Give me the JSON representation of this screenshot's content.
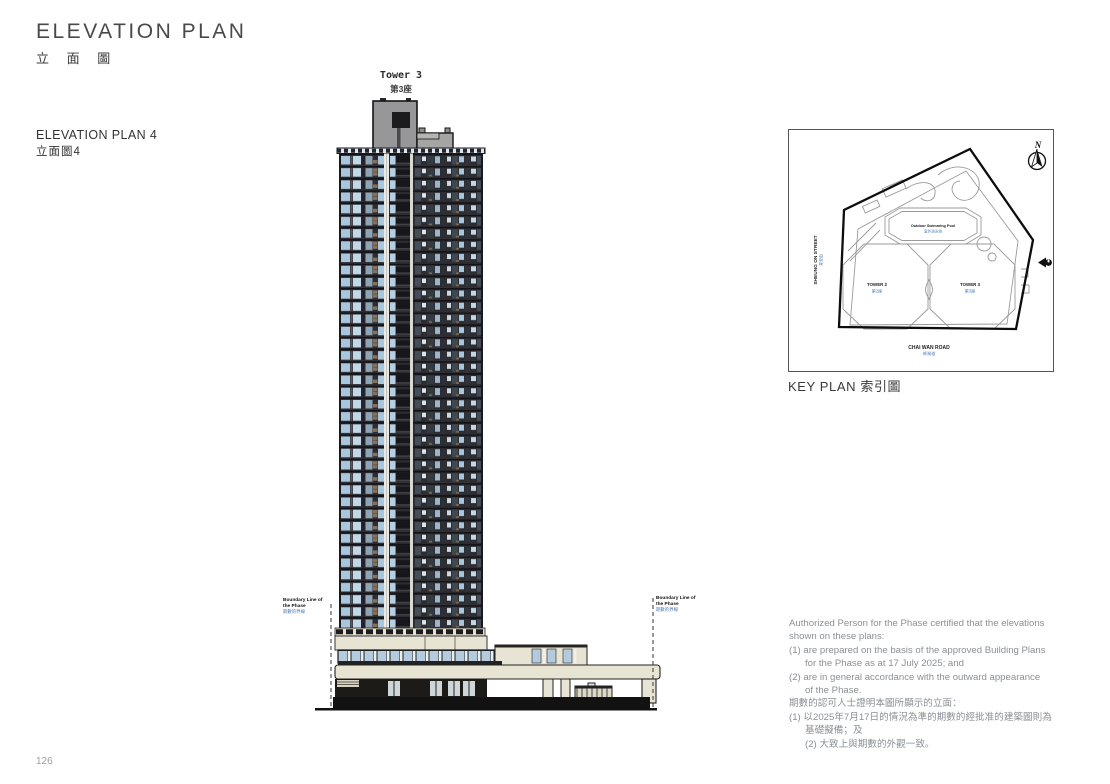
{
  "page": {
    "title_en": "ELEVATION PLAN",
    "title_zh": "立 面 圖",
    "plan_label_en": "ELEVATION PLAN 4",
    "plan_label_zh": "立面圖4",
    "page_number": "126"
  },
  "elevation": {
    "tower_label_en": "Tower 3",
    "tower_label_zh": "第3座",
    "boundary_label": {
      "en_line1": "Boundary Line of",
      "en_line2": "the Phase",
      "zh": "期數的界線"
    }
  },
  "key_plan": {
    "caption": "KEY PLAN 索引圖",
    "north_letter": "N",
    "street_left_en": "SHEUNG ON STREET",
    "street_left_zh": "常安街",
    "road_bottom_en": "CHAI WAN ROAD",
    "road_bottom_zh": "柴灣道",
    "pool_en": "Outdoor Swimming Pool",
    "pool_zh": "室外游泳池",
    "tower2_en": "TOWER 2",
    "tower2_zh": "第2座",
    "tower3_en": "TOWER 3",
    "tower3_zh": "第3座"
  },
  "certification": {
    "lines": [
      {
        "text": "Authorized Person for the Phase certified that the elevations",
        "indent": 0
      },
      {
        "text": "shown on these plans:",
        "indent": 0
      },
      {
        "text": "(1)  are prepared on the basis of the approved Building Plans",
        "indent": 0
      },
      {
        "text": "for the Phase as at 17 July 2025; and",
        "indent": 1
      },
      {
        "text": "(2)  are in general accordance with the outward appearance",
        "indent": 0
      },
      {
        "text": "of the Phase.",
        "indent": 1
      },
      {
        "text": "期數的認可人士證明本圖所顯示的立面：",
        "indent": 0
      },
      {
        "text": "(1)  以2025年7月17日的情況為準的期數的經批准的建築圖則為",
        "indent": 0
      },
      {
        "text": "基礎擬備；及",
        "indent": 1
      },
      {
        "text": "(2)  大致上與期數的外觀一致。",
        "indent": 1
      }
    ]
  },
  "colors": {
    "facade_glass": "#a9c6dd",
    "facade_frame": "#2c2c31",
    "facade_accent": "#8a7154",
    "podium_beige": "#e8e4d4",
    "chinese_label_blue": "#4a7ab5",
    "note_text_gray": "#8b9095"
  }
}
